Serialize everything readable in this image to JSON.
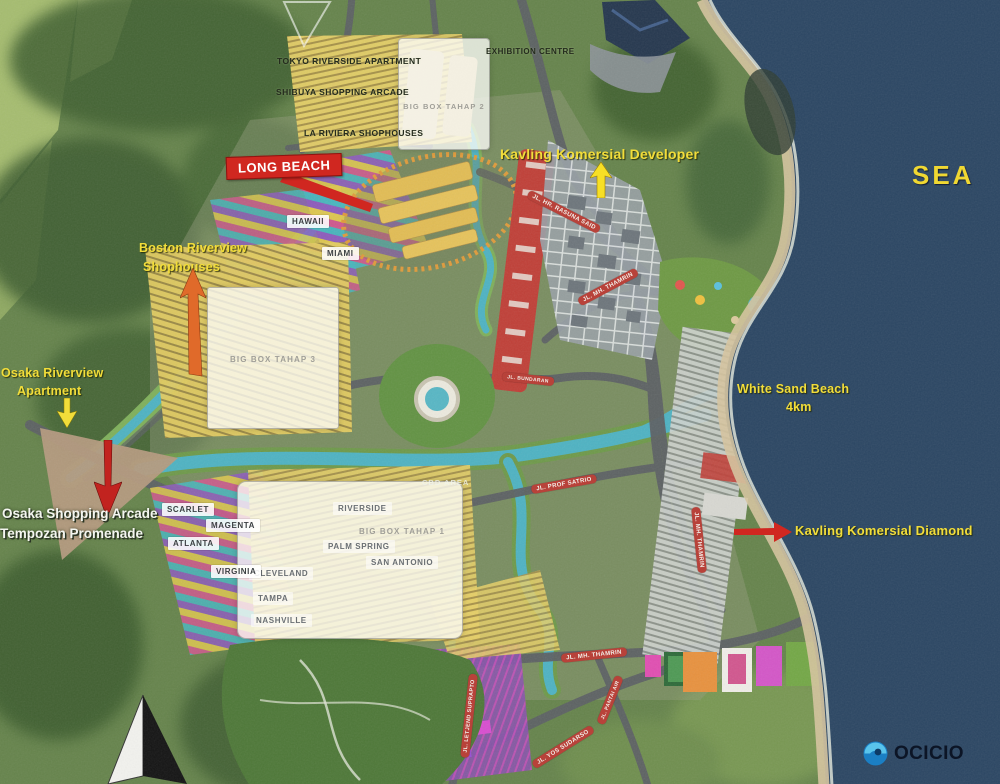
{
  "colors": {
    "sea": "#2b4663",
    "label_yellow": "#f2dd3a",
    "callout_red": "#d02720",
    "ribbon_red": "#b8423a",
    "logo_blue": "#2f9fd8",
    "logo_navy": "#0d1a30"
  },
  "sea_label": "SEA",
  "landmarks": {
    "tokyo": "TOKYO RIVERSIDE APARTMENT",
    "shibuya": "SHIBUYA SHOPPING ARCADE",
    "la_riviera": "LA RIVIERA SHOPHOUSES",
    "exhibition": "EXHIBITION CENTRE",
    "cbd_area": "CBD AREA"
  },
  "overlays": {
    "tahap2": "BIG BOX TAHAP 2",
    "tahap3": "BIG BOX TAHAP 3",
    "tahap1": "BIG BOX TAHAP 1"
  },
  "callouts": {
    "long_beach": "LONG BEACH",
    "kavling_developer": "Kavling Komersial Developer",
    "kavling_diamond": "Kavling Komersial Diamond",
    "boston": [
      "Boston Riverview",
      "Shophouses"
    ],
    "osaka_apartment": [
      "Osaka Riverview",
      "Apartment"
    ],
    "osaka_arcade": [
      "Osaka Shopping Arcade",
      "Tempozan Promenade"
    ],
    "white_sand": [
      "White Sand Beach",
      "4km"
    ]
  },
  "districts": [
    {
      "label": "HAWAII"
    },
    {
      "label": "MIAMI"
    },
    {
      "label": "SCARLET"
    },
    {
      "label": "MAGENTA"
    },
    {
      "label": "ATLANTA"
    },
    {
      "label": "VIRGINIA"
    },
    {
      "label": "RIVERSIDE"
    },
    {
      "label": "PALM SPRING"
    },
    {
      "label": "SAN ANTONIO"
    },
    {
      "label": "CLEVELAND"
    },
    {
      "label": "TAMPA"
    },
    {
      "label": "NASHVILLE"
    }
  ],
  "streets": [
    {
      "name": "JL. HR. RASUNA SAID"
    },
    {
      "name": "JL. MH. THAMRIN"
    },
    {
      "name": "JL. BUNDARAN"
    },
    {
      "name": "JL. PROF SATRIO"
    },
    {
      "name": "JL. MH. THAMRIN"
    },
    {
      "name": "JL. MH. THAMRIN"
    },
    {
      "name": "JL. YOS SUDARSO"
    },
    {
      "name": "JL. LETJEND SUPRAPTO"
    },
    {
      "name": "JL. PANTAI AIR"
    }
  ],
  "logo": {
    "brand": "OCICIO"
  }
}
